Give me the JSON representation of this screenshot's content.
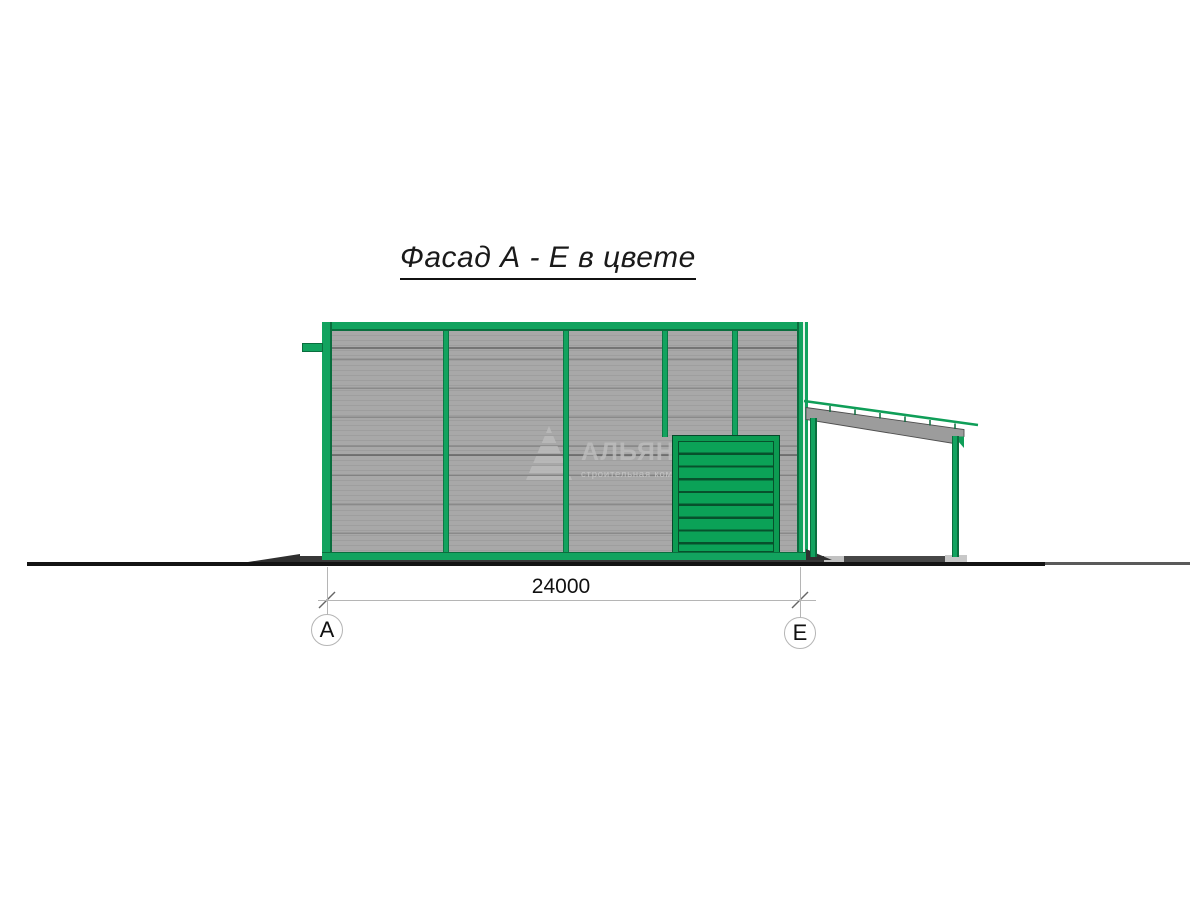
{
  "title": "Фасад А - Е в цвете",
  "watermark": {
    "name": "АЛЬЯНС",
    "subtitle": "строительная компания"
  },
  "dimension": {
    "value": "24000"
  },
  "axes": {
    "left": "А",
    "right": "Е"
  },
  "colors": {
    "frame-green": "#12a35f",
    "gate-line": "#07512c",
    "panel-gray": "#a8a8a8",
    "watermark-gray": "#bcbcbc"
  }
}
